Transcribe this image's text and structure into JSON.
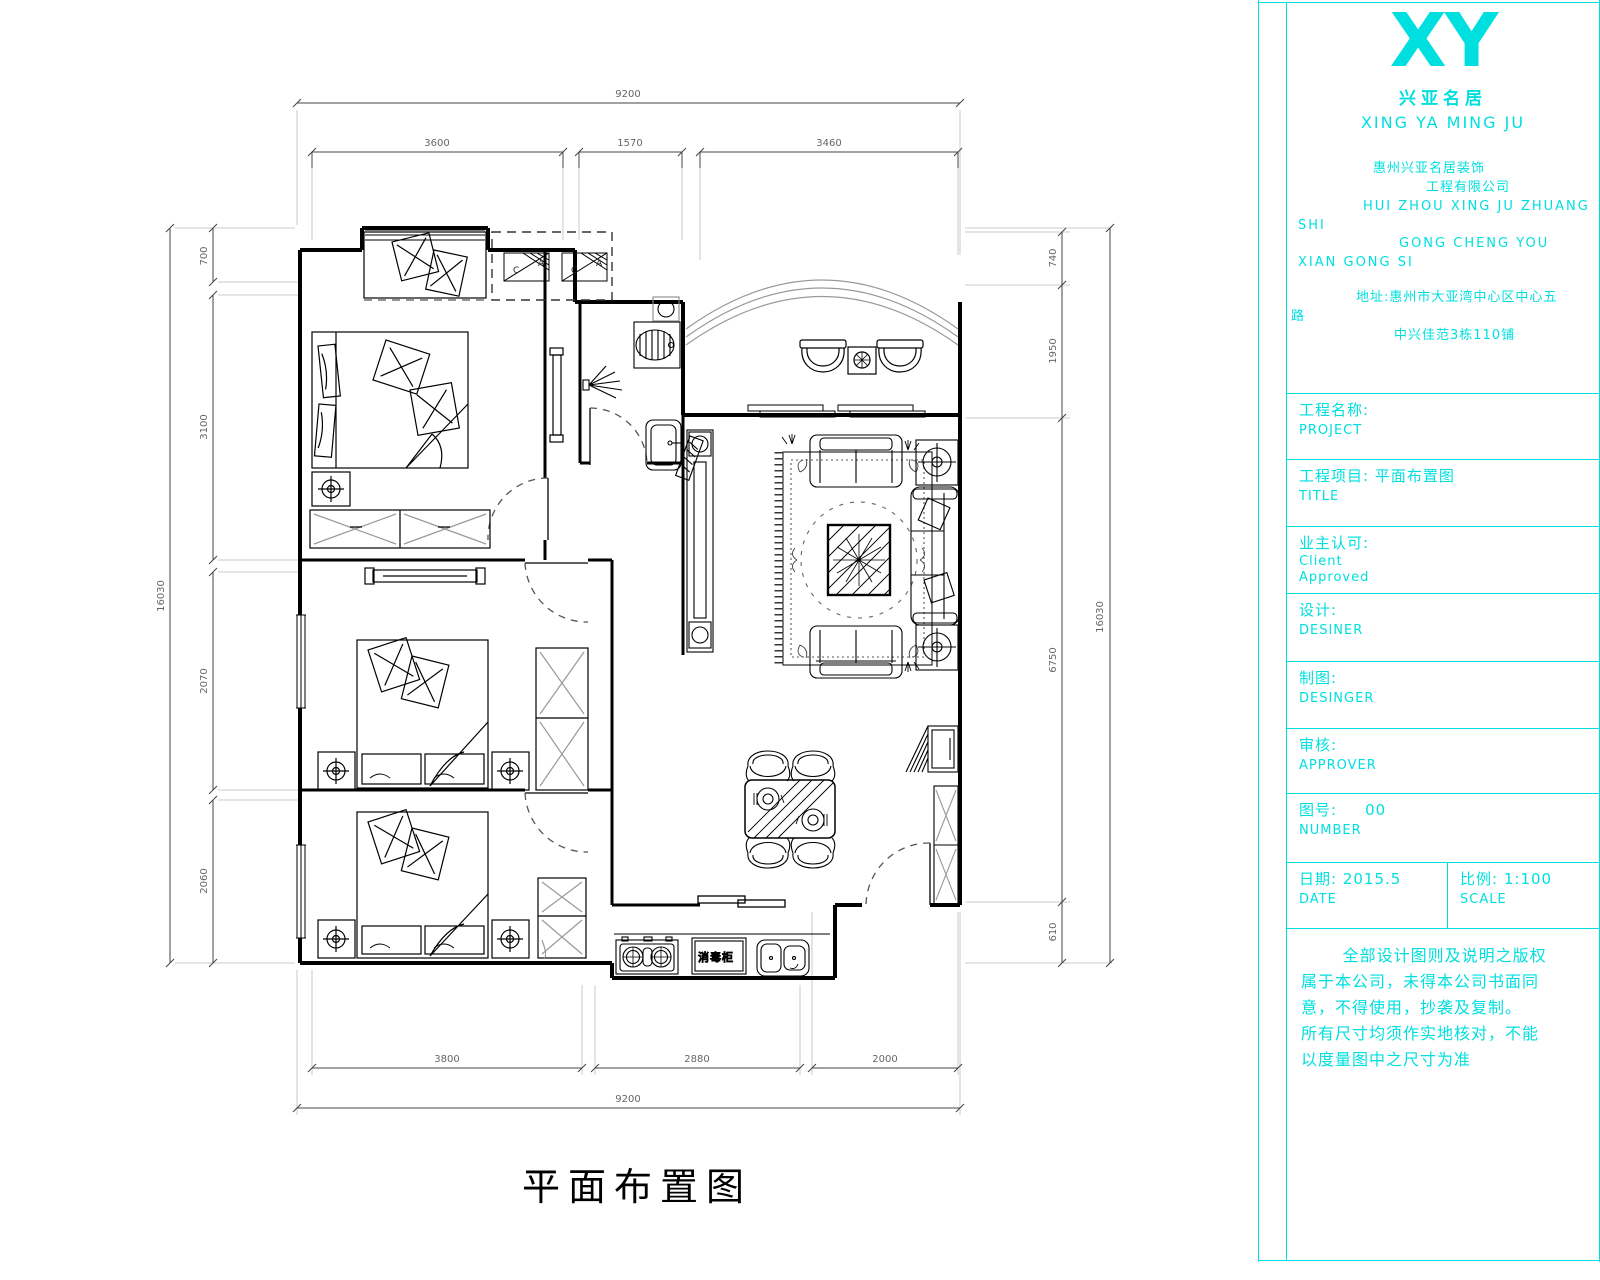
{
  "sheet": {
    "accent_color": "#00dfdf"
  },
  "plan": {
    "title": "平面布置图",
    "labels": {
      "disinfect_cabinet": "消毒柜",
      "appliance1_l": "C",
      "appliance1_r": "A",
      "appliance2_l": "C",
      "appliance2_r": "A"
    },
    "dims": {
      "top_overall": "9200",
      "top_seg_1": "3600",
      "top_seg_2": "1570",
      "top_seg_3": "3460",
      "left_overall": "16030",
      "left_seg_1": "700",
      "left_seg_2": "3100",
      "left_seg_3": "2070",
      "left_seg_4": "2060",
      "right_overall": "16030",
      "right_seg_1": "740",
      "right_seg_2": "1950",
      "right_seg_3": "6750",
      "right_seg_4": "610",
      "bottom_overall": "9200",
      "bottom_seg_1": "3800",
      "bottom_seg_2": "2880",
      "bottom_seg_3": "2000"
    }
  },
  "titleblock": {
    "logo": "XY",
    "brand_cn": "兴亚名居",
    "brand_en": "XING YA MING JU",
    "company_lines": {
      "l1": "惠州兴亚名居装饰",
      "l2": "工程有限公司",
      "l3": "HUI ZHOU XING JU ZHUANG",
      "l4": "SHI",
      "l5": "GONG CHENG YOU",
      "l6": "XIAN GONG SI",
      "l7": "地址:惠州市大亚湾中心区中心五",
      "l8": "路",
      "l9": "中兴佳范3栋110铺"
    },
    "rows": [
      {
        "label": "工程名称:",
        "sub": "PROJECT"
      },
      {
        "label": "工程项目: 平面布置图",
        "sub": "TITLE"
      },
      {
        "label": "业主认可:",
        "sub": "Client",
        "sub2": "Approved"
      },
      {
        "label": "设计:",
        "sub": "DESINER"
      },
      {
        "label": "制图:",
        "sub": "DESINGER"
      },
      {
        "label": "审核:",
        "sub": "APPROVER"
      },
      {
        "label": "图号:",
        "value": "00",
        "sub": "NUMBER"
      }
    ],
    "footer": {
      "date_label": "日期:",
      "date_value": "2015.5",
      "date_sub": "DATE",
      "scale_label": "比例:",
      "scale_value": "1:100",
      "scale_sub": "SCALE"
    },
    "notes": {
      "n1": "全部设计图则及说明之版权",
      "n2": "属于本公司，未得本公司书面同",
      "n3": "意，不得使用，抄袭及复制。",
      "n4": "所有尺寸均须作实地核对，不能",
      "n5": "以度量图中之尺寸为准"
    }
  }
}
